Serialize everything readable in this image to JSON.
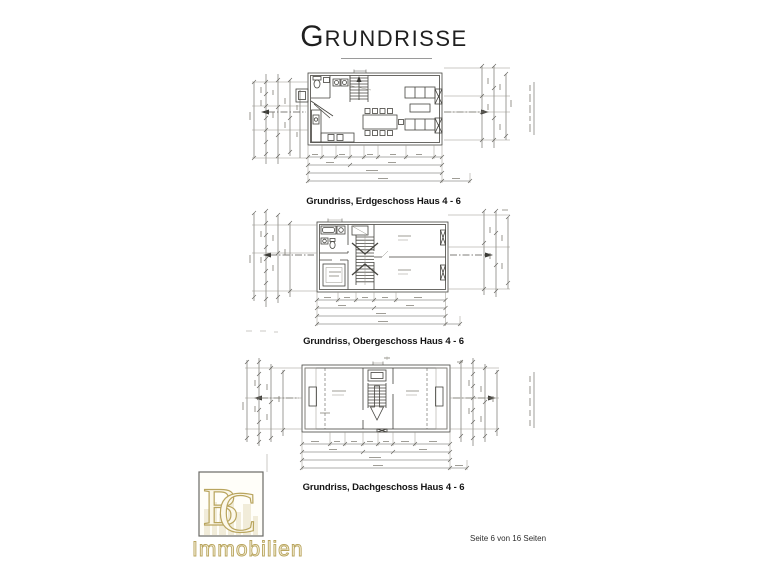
{
  "title": {
    "first": "G",
    "rest": "RUNDRISSE"
  },
  "plans": [
    {
      "caption": "Grundriss, Erdgeschoss  Haus 4 - 6"
    },
    {
      "caption": "Grundriss, Obergeschoss Haus 4 - 6"
    },
    {
      "caption": "Grundriss, Dachgeschoss Haus 4 - 6"
    }
  ],
  "logo": {
    "letter_b": "B",
    "letter_c": "C",
    "subtitle": "Immobilien",
    "gold": "#b9a55e"
  },
  "footer": "Seite 6 von 16 Seiten"
}
